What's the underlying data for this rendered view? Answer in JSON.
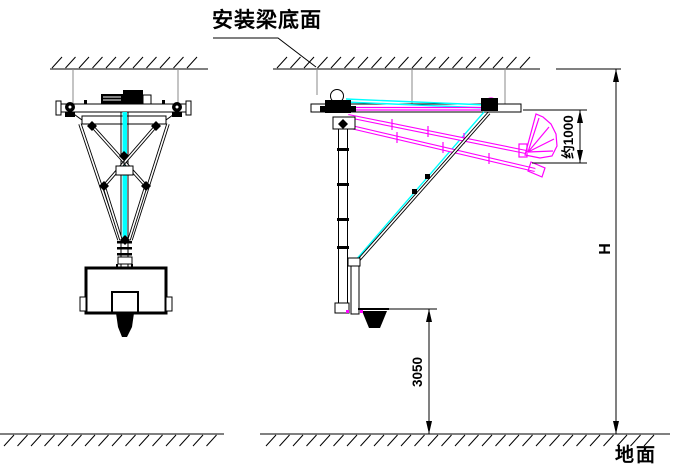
{
  "labels": {
    "beam_bottom": "安装梁底面",
    "ground": "地面"
  },
  "dimensions": {
    "fold_clearance": "约1000",
    "ceiling_height": "H",
    "rim_height": "3050"
  },
  "colors": {
    "line": "#000000",
    "folded_position": "#ff00ff",
    "cable": "#00ffff",
    "hanger_rod": "#8a8a8a",
    "background": "#ffffff"
  }
}
